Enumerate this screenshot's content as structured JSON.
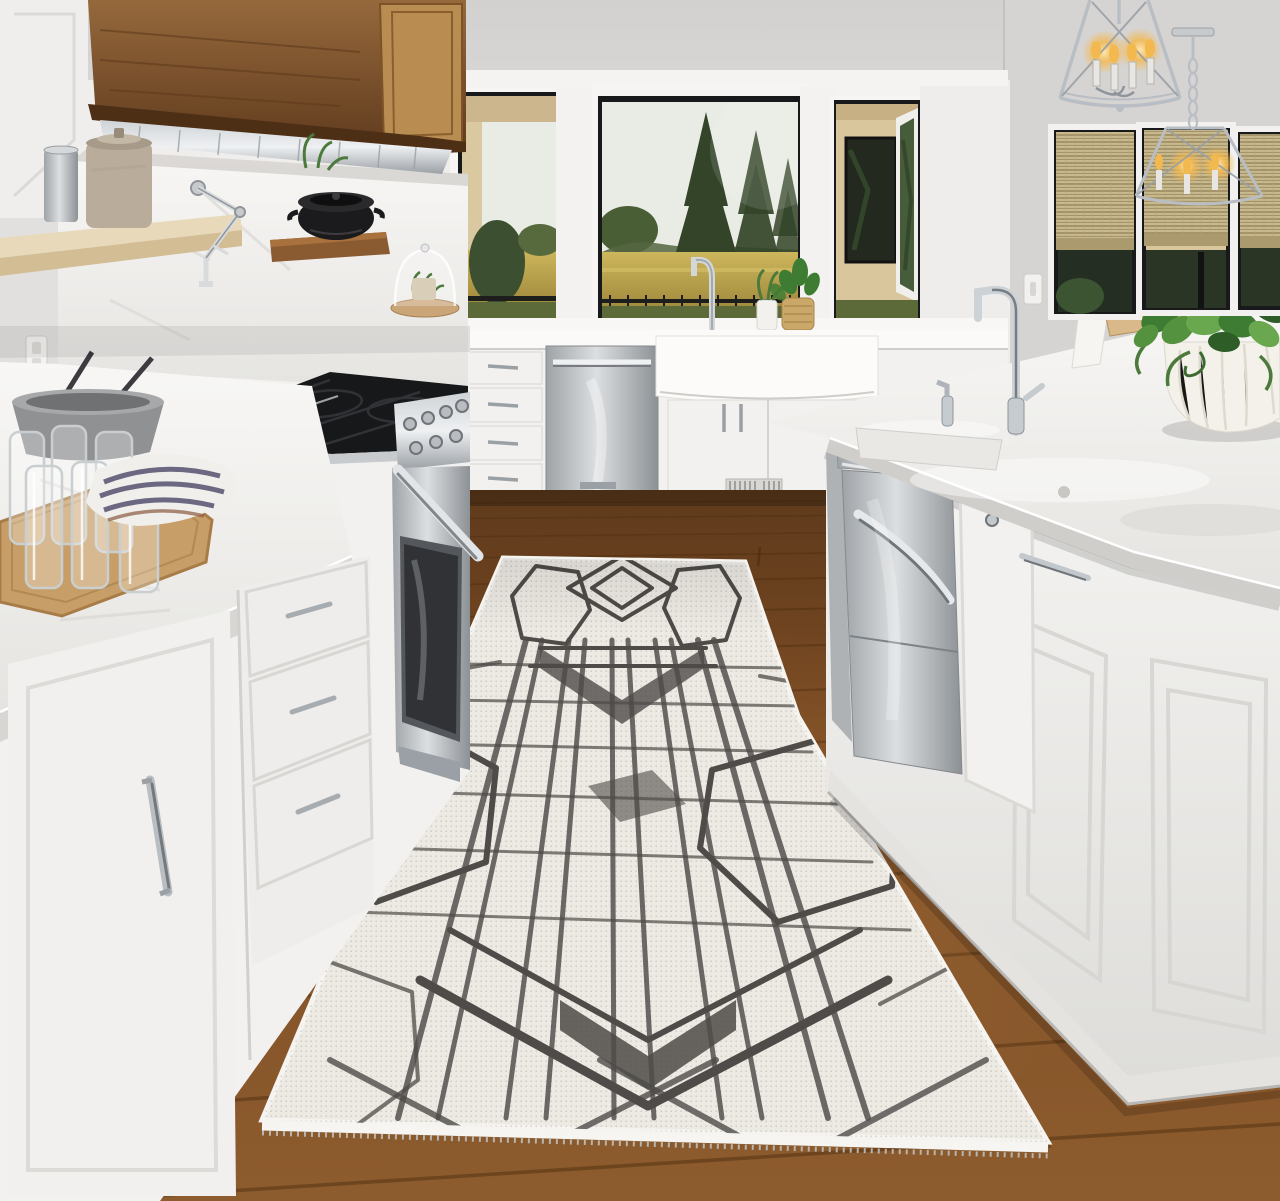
{
  "scene": {
    "type": "photograph",
    "setting": "bright white farmhouse kitchen with hardwood floor and a geometric runner rug",
    "objects": {
      "rug": "white-and-charcoal geometric runner rug",
      "floor": "medium brown hardwood plank floor",
      "hood": "wood paneled range hood with stainless vent",
      "range": "stainless professional gas range",
      "cooktop": "black gas cooktop grates",
      "island": "large white kitchen island with marble top",
      "island_sink": "stainless farmhouse apron sink",
      "island_dishwasher": "stainless drawer dishwasher",
      "back_dishwasher": "stainless dishwasher with bar handle",
      "farm_sink": "white farmhouse sink",
      "window_view": "windows with evergreen trees, golden field and black fence",
      "pendants": "polished chrome lantern pendant lights with candle bulbs",
      "shades": "woven natural roman shades",
      "plant": "pothos plant in white fluted bowl",
      "tray": "wood tray with drinking glasses, gray bowl and striped towel",
      "cloche": "glass cloche with small plant",
      "pot_filler": "chrome wall mounted pot filler",
      "pot": "black cast iron pot on wood shelf",
      "crock": "stone crock and steel canister on open shelf"
    }
  },
  "palette": {
    "wall": "#e7e5e3",
    "wall_shaded": "#d6d4d2",
    "ceiling": "#dcdad8",
    "cabinet_white": "#f2f1ef",
    "marble": "#efeeec",
    "stainless": "#b7bcc0",
    "wood_cabinet": "#8a5c33",
    "wood_floor": "#7c4b23",
    "rug_base": "#edeae4",
    "rug_pattern": "#4e4b48",
    "window_sky": "#e9ece4",
    "window_trees": "#334428",
    "window_field": "#c2ab50",
    "plant_green": "#3f7c33",
    "flame": "#f3b94f",
    "fence_black": "#1d1d1b"
  }
}
